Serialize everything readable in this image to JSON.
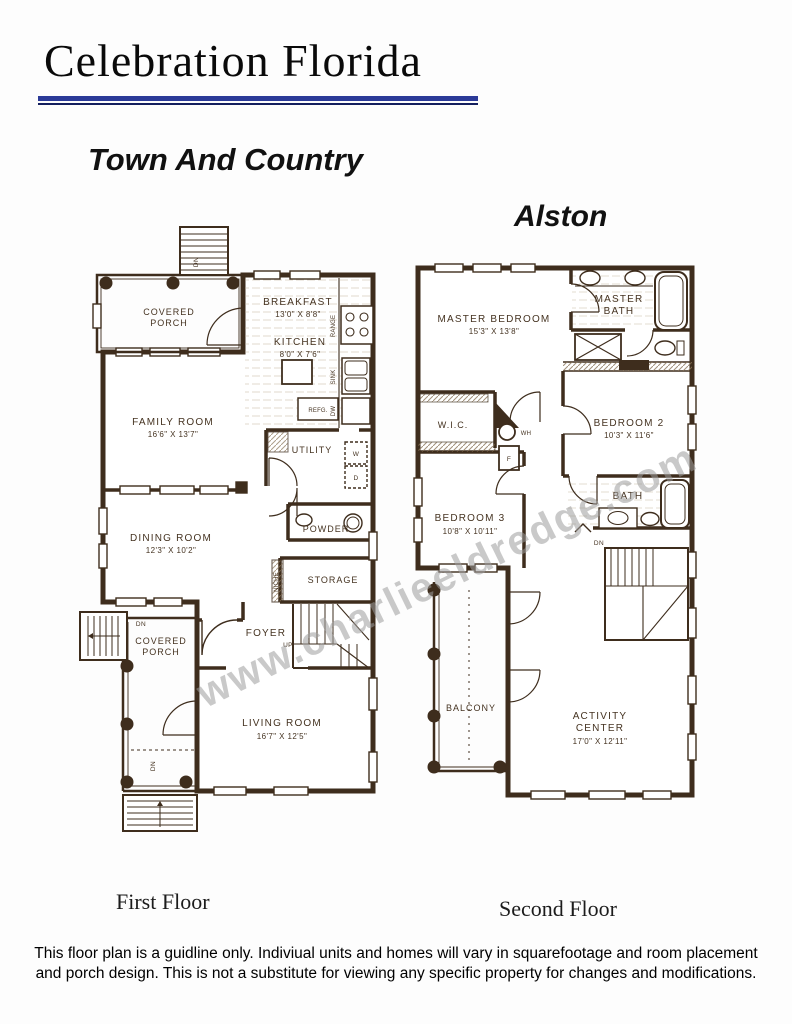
{
  "header": {
    "title": "Celebration Florida",
    "community": "Town And Country",
    "model": "Alston"
  },
  "watermark": "www.charlieeldredge.com",
  "colors": {
    "accent_blue": "#2b3a98",
    "accent_blue_dark": "#141f5e",
    "plan_ink": "#3e2d1d",
    "label_ink": "#453321",
    "watermark_gray": "#9d9d9d"
  },
  "first_floor": {
    "caption": "First Floor",
    "covered_porch_top_line1": "COVERED",
    "covered_porch_top_line2": "PORCH",
    "breakfast": "BREAKFAST",
    "breakfast_dims": "13'0\" X 8'8\"",
    "kitchen": "KITCHEN",
    "kitchen_dims": "8'0\" X 7'6\"",
    "family_room": "FAMILY ROOM",
    "family_room_dims": "16'6\" X 13'7\"",
    "utility": "UTILITY",
    "washer": "W",
    "dryer": "D",
    "range": "RANGE",
    "sink": "SINK",
    "dishwasher": "DW",
    "refrigerator": "REFG.",
    "dining_room": "DINING ROOM",
    "dining_room_dims": "12'3\" X 10'2\"",
    "powder": "POWDER",
    "storage": "STORAGE",
    "niche": "NICHE",
    "foyer": "FOYER",
    "up": "UP",
    "dn_top_stairs": "DN",
    "dn_left_stairs": "DN",
    "dn_porch": "DN",
    "covered_porch_bottom_line1": "COVERED",
    "covered_porch_bottom_line2": "PORCH",
    "living_room": "LIVING ROOM",
    "living_room_dims": "16'7\" X 12'5\""
  },
  "second_floor": {
    "caption": "Second Floor",
    "master_bedroom": "MASTER BEDROOM",
    "master_bedroom_dims": "15'3\" X 13'8\"",
    "master_bath_line1": "MASTER",
    "master_bath_line2": "BATH",
    "wic": "W.I.C.",
    "water_heater": "WH",
    "furnace": "F",
    "bedroom2": "BEDROOM 2",
    "bedroom2_dims": "10'3\" X 11'6\"",
    "bedroom3": "BEDROOM 3",
    "bedroom3_dims": "10'8\" X 10'11\"",
    "bath": "BATH",
    "dn": "DN",
    "balcony": "BALCONY",
    "activity_line1": "ACTIVITY",
    "activity_line2": "CENTER",
    "activity_dims": "17'0\" X 12'11\""
  },
  "footer": {
    "disclaimer_line1": "This floor plan is a guidline only.  Indiviual units and homes will vary in squarefootage and room placement",
    "disclaimer_line2": "and porch design. This is not a substitute for viewing any specific property for changes and modifications."
  }
}
